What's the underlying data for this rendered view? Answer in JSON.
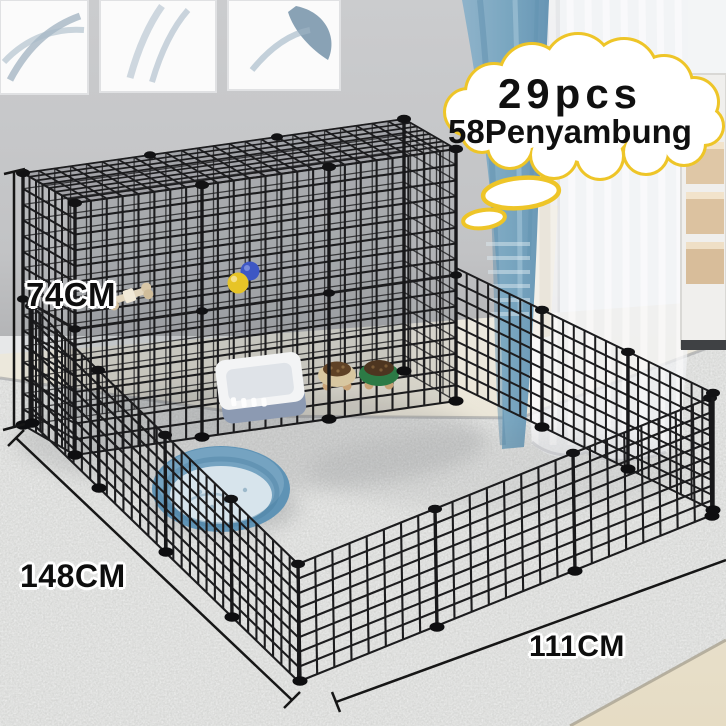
{
  "callout": {
    "line1": "29pcs",
    "line2": "58Penyambung"
  },
  "dimensions": {
    "height": "74CM",
    "length": "148CM",
    "width": "111CM"
  },
  "palette": {
    "callout_border": "#EEC528",
    "callout_fill": "#FFFFFF",
    "callout_text": "#101010",
    "label_text": "#0E0E0E",
    "label_outline": "#FFFFFF",
    "wire_black": "#1C1C1E",
    "wall_gray": "#C7C8CA",
    "rug_gray": "#D7D8D6",
    "floor_beige": "#E9E3D4",
    "curtain_blue": "#7FA9C2",
    "curtain_sheer": "#F2F4F6",
    "pet_bed_rim": "#5F93B5",
    "pet_bed_cushion": "#D7E4EC",
    "litter_box_body": "#8C9AB2",
    "litter_box_rim": "#F3F4F5",
    "bowl_cream": "#D8C7A0",
    "bowl_green": "#2C7A45",
    "ball_blue": "#3E57C4",
    "ball_yellow": "#E7C427",
    "wood_accent": "#C8A377"
  }
}
